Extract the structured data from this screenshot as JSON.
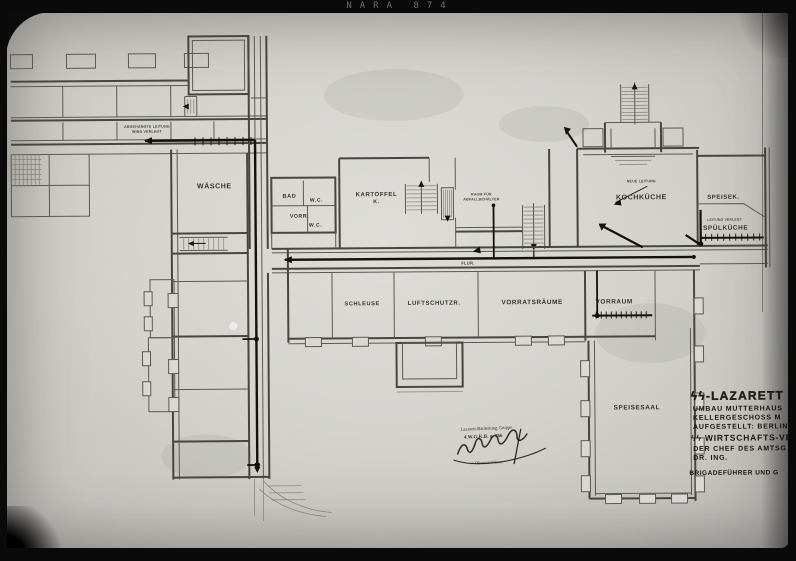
{
  "photo": {
    "archive_label": "NARA 874"
  },
  "colors": {
    "paper": "#d4d3ce",
    "pencil": "#49453e",
    "ink": "#14110d",
    "photo_black": "#0b0b0b"
  },
  "plan": {
    "rooms": {
      "waesche": "WÄSCHE",
      "bad": "BAD",
      "wc_upper": "W.C.",
      "vorr": "VORR.",
      "wc_lower": "W.C.",
      "kartoffel_line1": "KARTOFFEL",
      "kartoffel_line2": "K.",
      "flur": "FLUR.",
      "schleuse": "SCHLEUSE",
      "luftschutz": "LUFTSCHUTZR.",
      "vorratsraeume": "VORRATSRÄUME",
      "vorraum": "VORRAUM",
      "kochkueche": "KOCHKÜCHE",
      "speisekammer": "SPEISEK.",
      "spuelkueche": "SPÜLKÜCHE",
      "speisesaal": "SPEISESAAL"
    },
    "annotations": {
      "wing_note_line1": "ABGEHÄNGTE LEITUNG",
      "wing_note_line2": "WIRD VERLEGT",
      "store_note_line1": "RAUM FÜR",
      "store_note_line2": "ABFALLBEHÄLTER",
      "kitchen_note": "NEUE LEITUNG",
      "scullery_note": "LEITUNG VERLEGT"
    },
    "title_block": {
      "line1": "ϟϟ-LAZARETT BER",
      "line2": "UMBAU MUTTERHAUS",
      "line3": "KELLERGESCHOSS M",
      "line4": "AUFGESTELLT: BERLIN",
      "line5": "ϟϟ WIRTSCHAFTS-VER",
      "line6": "DER CHEF DES AMTSG",
      "line7": "DR. ING.",
      "line8": "BRIGADEFÜHRER UND G"
    },
    "stamp": {
      "line1": "Lazarett-Bauleitung Gruppe",
      "line2": "4.W.G.K.B. u. 766",
      "line3": "ϟϟ-Obersturmführer"
    }
  }
}
